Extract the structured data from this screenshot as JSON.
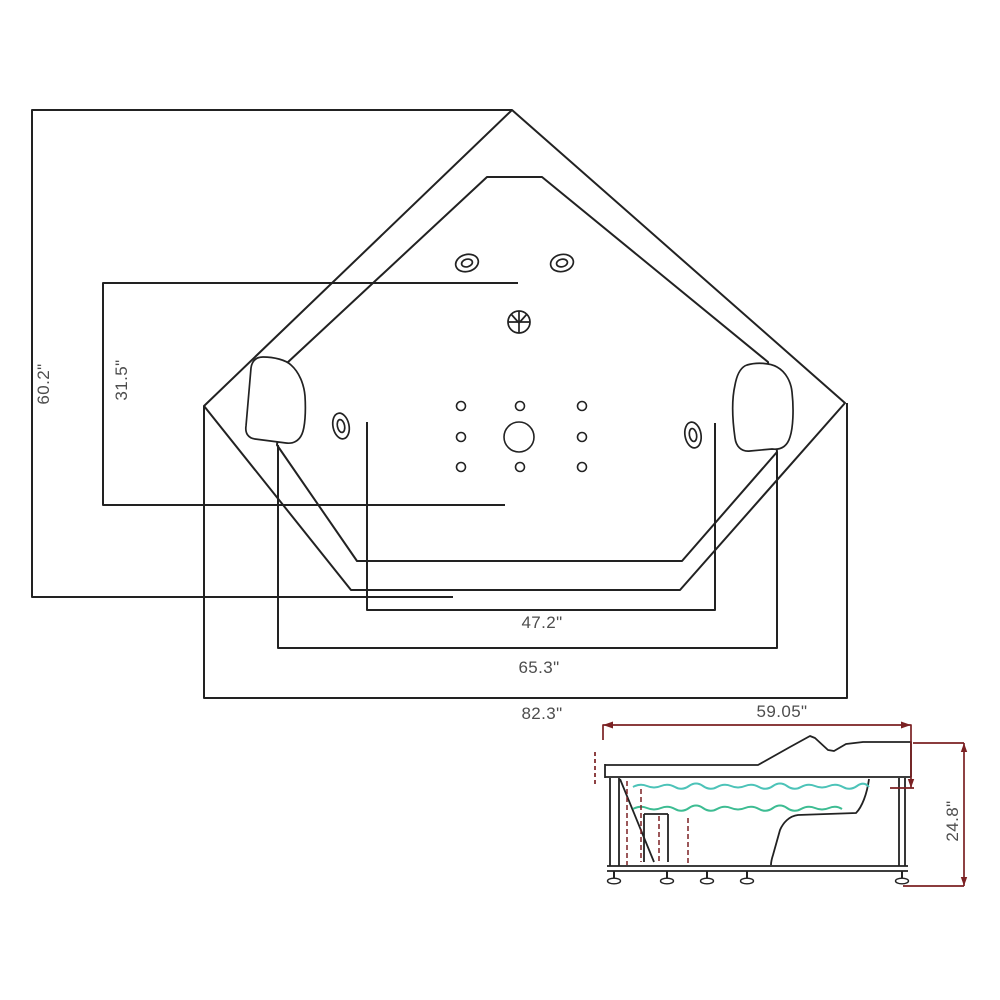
{
  "page": {
    "description": "Technical specification line drawing of a corner whirlpool bathtub: plan (top) view with dimension boxes and a side elevation view with dimension lines",
    "background": "#ffffff"
  },
  "colors": {
    "outline": "#222222",
    "label_text": "#4d4d4d",
    "dimension_accent": "#7b2123",
    "water_upper": "#4cc3b8",
    "water_lower": "#3dbc92"
  },
  "top_view": {
    "name": "bathtub-plan-view",
    "dimensions": {
      "depth_overall": {
        "label": "60.2\"",
        "orientation": "vertical"
      },
      "depth_inner": {
        "label": "31.5\"",
        "orientation": "vertical"
      },
      "width_front_edge": {
        "label": "47.2\"",
        "orientation": "horizontal"
      },
      "width_inner": {
        "label": "65.3\"",
        "orientation": "horizontal"
      },
      "width_overall": {
        "label": "82.3\"",
        "orientation": "horizontal"
      }
    },
    "features": {
      "headrests": 2,
      "top_oval_jets": 2,
      "side_oval_jets": 2,
      "small_back_jets": 8,
      "central_suction": 1,
      "drain": 1
    }
  },
  "side_view": {
    "name": "bathtub-side-elevation",
    "dimensions": {
      "length_top": {
        "label": "59.05\"",
        "orientation": "horizontal"
      },
      "height": {
        "label": "24.8\"",
        "orientation": "vertical"
      }
    },
    "features": {
      "water_lines": 2,
      "legs_with_feet": 5,
      "drain_pipes_dashed": 4
    }
  }
}
